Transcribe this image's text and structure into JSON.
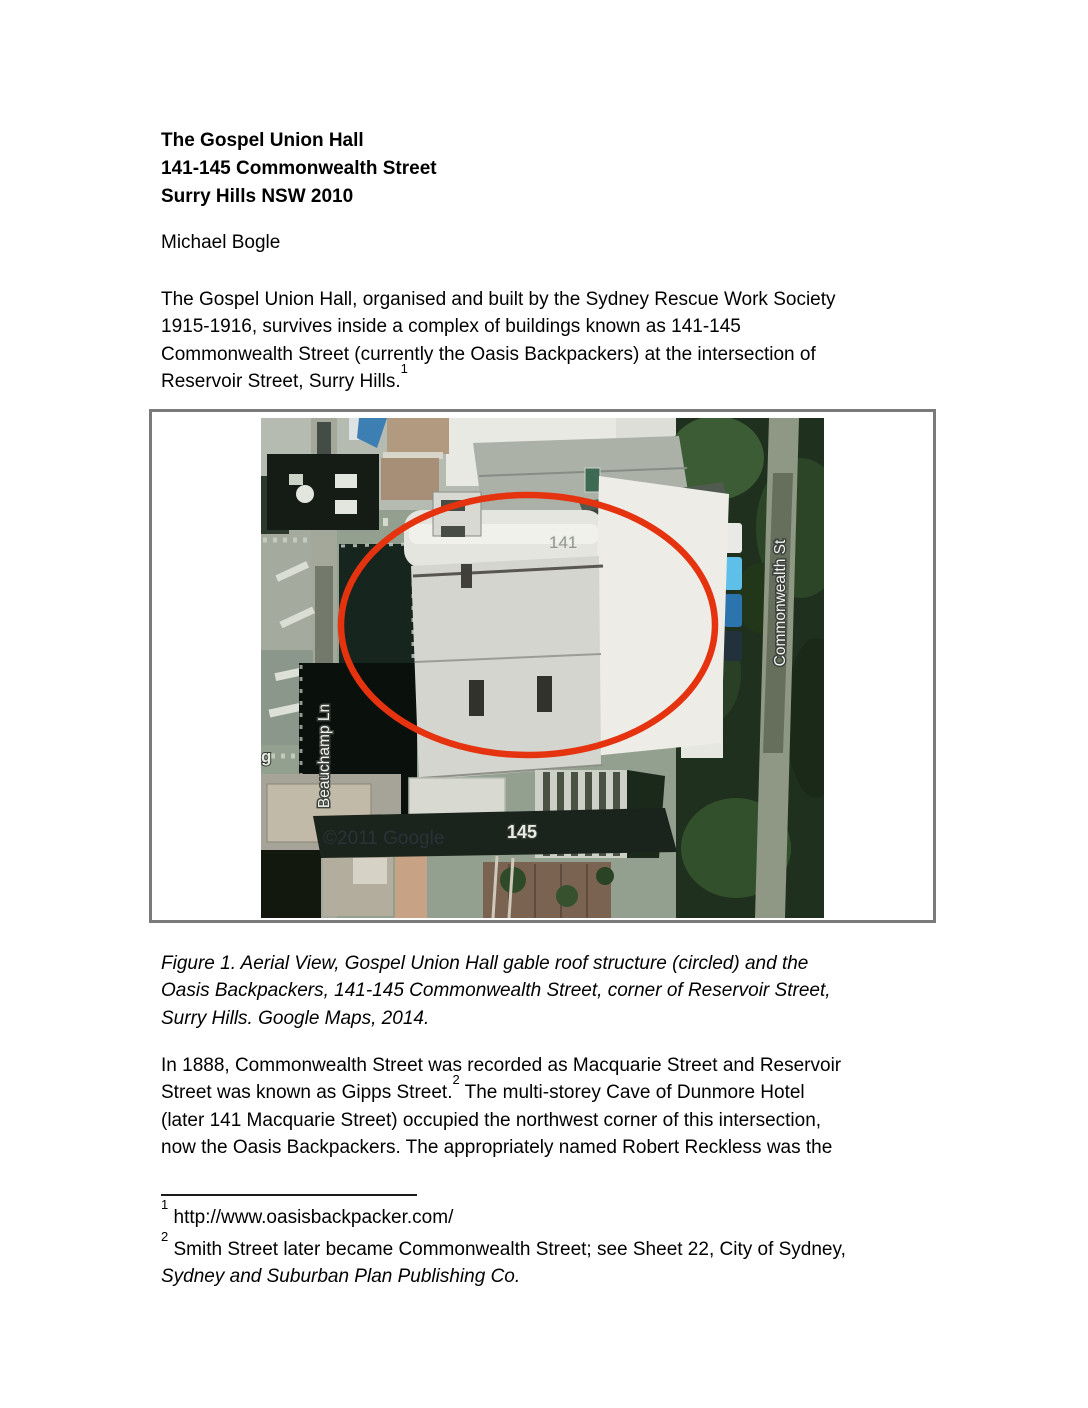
{
  "doc": {
    "title_lines": [
      "The Gospel Union Hall",
      "141-145 Commonwealth Street",
      "Surry Hills NSW 2010"
    ],
    "author": "Michael Bogle",
    "intro": {
      "lines": [
        "The Gospel Union Hall, organised and built by the Sydney Rescue Work Society",
        "1915-1916, survives inside a complex of buildings known as 141-145",
        "Commonwealth Street (currently the Oasis Backpackers) at the intersection of"
      ],
      "last_line": "Reservoir Street, Surry Hills.",
      "footnote_ref": "1"
    },
    "figure": {
      "caption_lines": [
        "Figure 1. Aerial View, Gospel Union Hall gable roof structure (circled) and the",
        "Oasis Backpackers, 141-145 Commonwealth Street, corner of Reservoir Street,",
        "Surry Hills. Google Maps, 2014."
      ],
      "labels": {
        "street_right": "Commonwealth St",
        "lane_left": "Beauchamp Ln",
        "number_top": "141",
        "number_bottom": "145",
        "partial_left": "g",
        "watermark": "©2011 Google"
      },
      "colors": {
        "circle": "#e6330f",
        "border": "#7a7a7a"
      }
    },
    "body": {
      "line1": "In 1888, Commonwealth Street was recorded as Macquarie Street and Reservoir",
      "line2_a": "Street was known as Gipps Street.",
      "footnote_ref": "2",
      "line2_b": " The multi-storey Cave of Dunmore Hotel",
      "line3": "(later 141 Macquarie Street) occupied the northwest corner of this intersection,",
      "line4": "now the Oasis Backpackers. The appropriately named Robert Reckless was the"
    },
    "footnotes": {
      "fn1": {
        "ref": "1",
        "text": " http://www.oasisbackpacker.com/"
      },
      "fn2": {
        "ref": "2",
        "line1": " Smith Street later became Commonwealth Street; see Sheet 22, City of Sydney,",
        "line2_italic": "Sydney and Suburban Plan Publishing Co."
      }
    }
  }
}
